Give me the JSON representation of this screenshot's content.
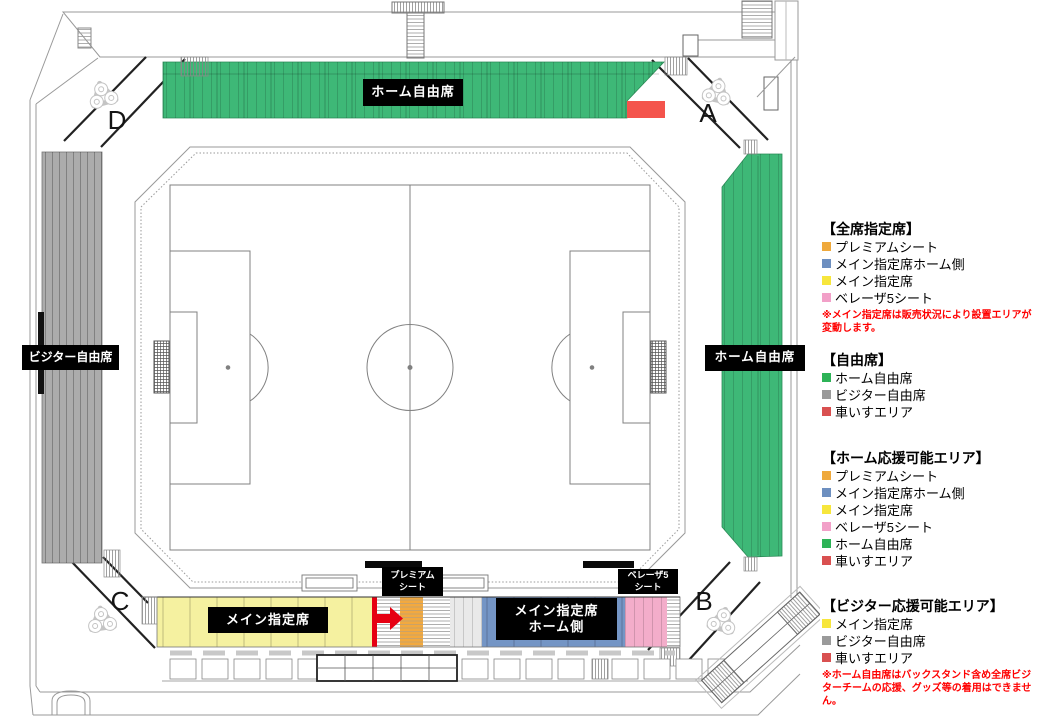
{
  "corners": {
    "top_left": "D",
    "top_right": "A",
    "bottom_left": "C",
    "bottom_right": "B"
  },
  "stands": {
    "back": {
      "label": "ホーム自由席"
    },
    "side_right": {
      "label": "ホーム自由席"
    },
    "side_left": {
      "label": "ビジター自由席"
    },
    "main_reserved": {
      "label": "メイン指定席"
    },
    "premium": {
      "label": "プレミアム\nシート"
    },
    "main_home": {
      "label": "メイン指定席\nホーム側"
    },
    "beleza5": {
      "label": "ベレーザ5\nシート"
    }
  },
  "legend": {
    "sections": [
      {
        "title": "【全席指定席】",
        "items": [
          {
            "color": "orange",
            "label": "プレミアムシート"
          },
          {
            "color": "blue",
            "label": "メイン指定席ホーム側"
          },
          {
            "color": "yellow",
            "label": "メイン指定席"
          },
          {
            "color": "pink",
            "label": "ベレーザ5シート"
          }
        ],
        "note": "※メイン指定席は販売状況により設置エリアが変動します。"
      },
      {
        "title": "【自由席】",
        "items": [
          {
            "color": "green",
            "label": "ホーム自由席"
          },
          {
            "color": "gray",
            "label": "ビジター自由席"
          },
          {
            "color": "red",
            "label": "車いすエリア"
          }
        ]
      },
      {
        "title": "【ホーム応援可能エリア】",
        "items": [
          {
            "color": "orange",
            "label": "プレミアムシート"
          },
          {
            "color": "blue",
            "label": "メイン指定席ホーム側"
          },
          {
            "color": "yellow",
            "label": "メイン指定席"
          },
          {
            "color": "pink",
            "label": "ベレーザ5シート"
          },
          {
            "color": "green",
            "label": "ホーム自由席"
          },
          {
            "color": "red",
            "label": "車いすエリア"
          }
        ]
      },
      {
        "title": "【ビジター応援可能エリア】",
        "items": [
          {
            "color": "yellow",
            "label": "メイン指定席"
          },
          {
            "color": "gray",
            "label": "ビジター自由席"
          },
          {
            "color": "red",
            "label": "車いすエリア"
          }
        ],
        "note": "※ホーム自由席はバックスタンド含め全席ビジターチームの応援、グッズ等の着用はできません。"
      }
    ]
  },
  "colors": {
    "home_free_green": "#3EB877",
    "visitor_free_gray": "#ACACAC",
    "main_reserved_yellow": "#F5F1A0",
    "premium_orange": "#F2A93F",
    "main_home_blue": "#7495C5",
    "beleza5_pink": "#F3ADCA",
    "wheelchair_red": "#F4544C",
    "arrow_red": "#E60012",
    "note_red": "#FF0000",
    "label_bg": "#000000",
    "label_text": "#FFFFFF"
  }
}
